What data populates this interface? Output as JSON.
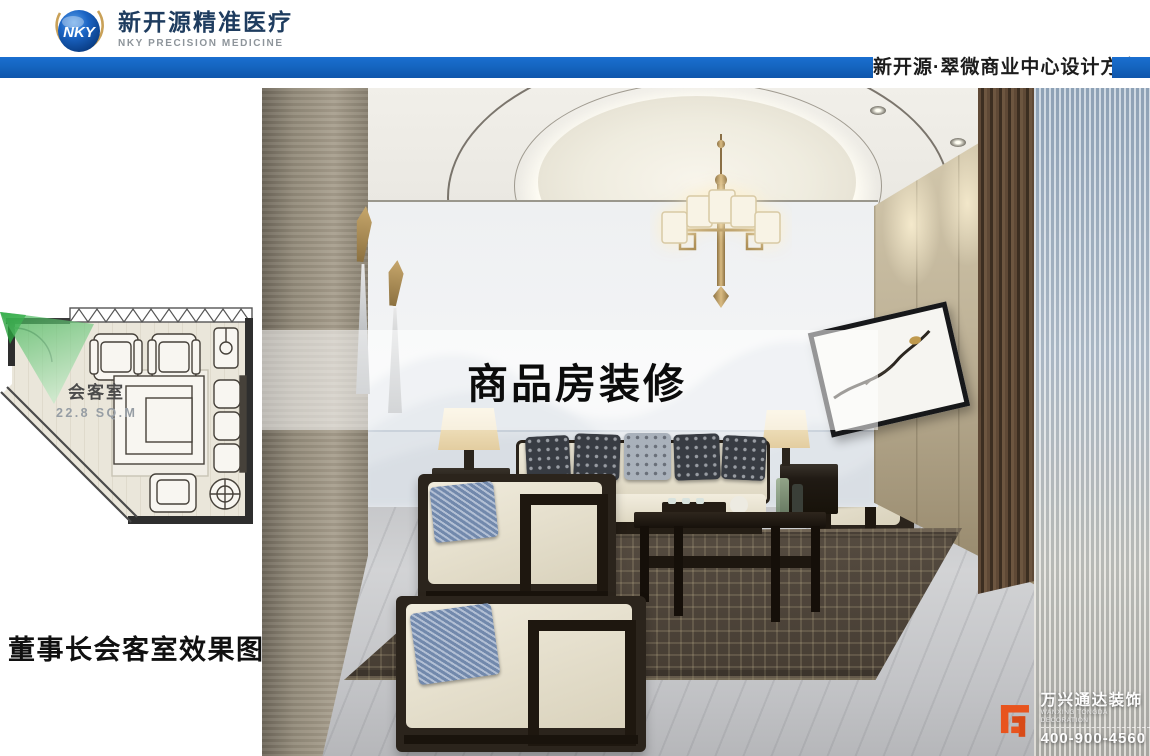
{
  "header": {
    "logo": {
      "sphere_text": "NKY",
      "company_cn": "新开源精准医疗",
      "company_en": "NKY PRECISION MEDICINE"
    },
    "banner": {
      "title": "新开源·翠微商业中心设计方案",
      "bar_color": "#1565c0"
    }
  },
  "floor_plan": {
    "room_name": "会客室",
    "room_area": "22.8 SQ.M"
  },
  "caption": "董事长会客室效果图",
  "render": {
    "watermark": "商品房装修",
    "vendor": {
      "name_cn": "万兴通达装饰",
      "name_en": "WANXING TONGDA DECORATION",
      "phone": "400-900-4560"
    }
  },
  "colors": {
    "banner_blue": "#1565c0",
    "logo_navy": "#1e3c5f",
    "logo_gold": "#c9a158",
    "vendor_orange": "#e8541e",
    "plan_view_green": "#4cbb61"
  }
}
